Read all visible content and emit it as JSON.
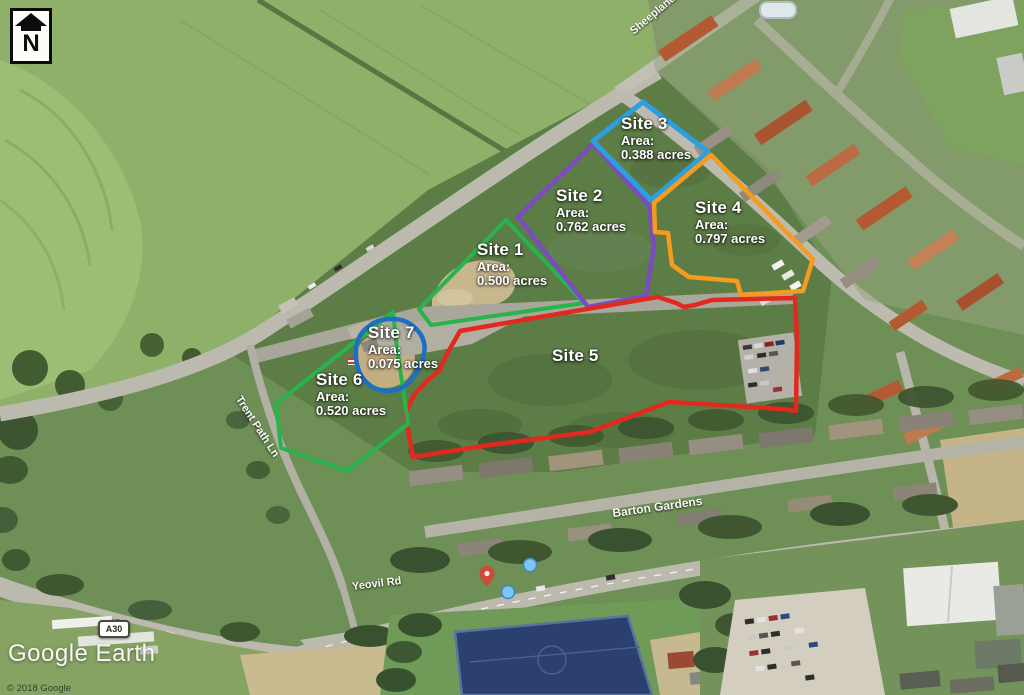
{
  "map": {
    "watermark": "Google Earth",
    "copyright": "© 2018 Google",
    "north_indicator": "N"
  },
  "sites": [
    {
      "name": "Site 1",
      "area_label": "Area:",
      "area": "0.500 acres",
      "color": "#28b44c"
    },
    {
      "name": "Site 2",
      "area_label": "Area:",
      "area": "0.762 acres",
      "color": "#7a4cc0"
    },
    {
      "name": "Site 3",
      "area_label": "Area:",
      "area": "0.388 acres",
      "color": "#2d9fe0"
    },
    {
      "name": "Site 4",
      "area_label": "Area:",
      "area": "0.797 acres",
      "color": "#f59c1e"
    },
    {
      "name": "Site 5",
      "color": "#e2291f"
    },
    {
      "name": "Site 6",
      "area_label": "Area:",
      "area": "0.520 acres",
      "color": "#28b44c"
    },
    {
      "name": "Site 7",
      "area_label": "Area:",
      "area": "0.075 acres",
      "color": "#1d6fc4"
    }
  ],
  "roads": [
    {
      "name": "Sheeplands Ln"
    },
    {
      "name": "Trent Path Ln"
    },
    {
      "name": "Barton Gardens"
    },
    {
      "name": "Yeovil Rd"
    },
    {
      "name": "A30"
    }
  ],
  "markers": [
    {
      "type": "place-pin",
      "color": "#d84336"
    },
    {
      "type": "photo-dot",
      "color": "#7fc4f2"
    },
    {
      "type": "photo-dot",
      "color": "#7fc4f2"
    }
  ]
}
